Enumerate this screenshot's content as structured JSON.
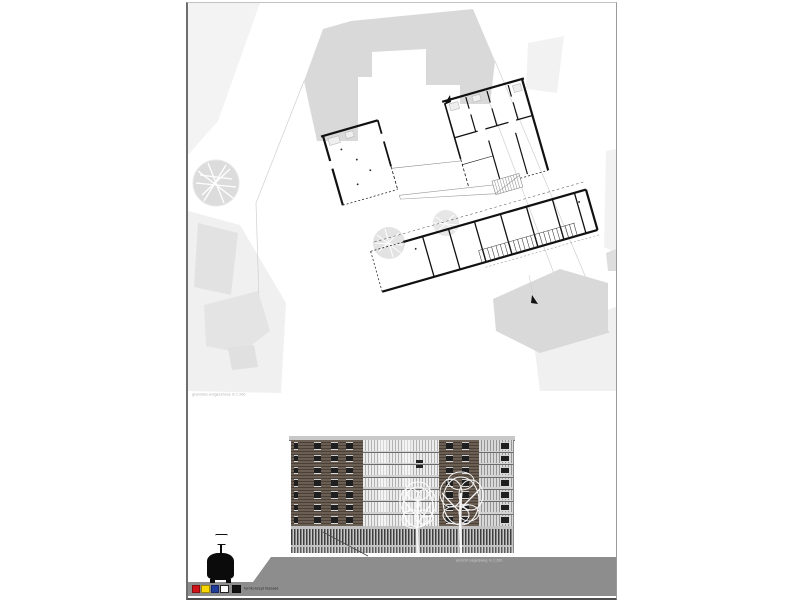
{
  "sheet": {
    "background": "#ffffff",
    "border_color": "#6e6e6e"
  },
  "site_plan": {
    "caption": "grundriss erdgeschoss m 1:200",
    "context_fill": "#d9d9d9",
    "context_fill_light": "#e4e4e4",
    "street_fill": "#f1f1f1",
    "plan_line_color": "#111111",
    "tree_fill": "#dcdcdc"
  },
  "elevation": {
    "caption": "ansicht nagelsweg m 1:200",
    "ground_color": "#8d8d8d",
    "facade_wood_color": "#6b5e53",
    "facade_glass_light": "#ececec",
    "facade_glass_dark": "#b2b2b2",
    "window_color": "#1f1f1f",
    "roof_color": "#c8c8c8",
    "tree_color": "#ffffff",
    "floors": 7
  },
  "sculpture": {
    "body_color": "#0b0b0b",
    "lamp_color": "#ffffff"
  },
  "legend": {
    "label": "farbkonzept fassade",
    "swatches": [
      {
        "name": "red",
        "color": "#d01317"
      },
      {
        "name": "yellow",
        "color": "#f8d800"
      },
      {
        "name": "blue",
        "color": "#1f3d99"
      },
      {
        "name": "white",
        "color": "#ffffff"
      },
      {
        "name": "black",
        "color": "#111111"
      }
    ]
  }
}
